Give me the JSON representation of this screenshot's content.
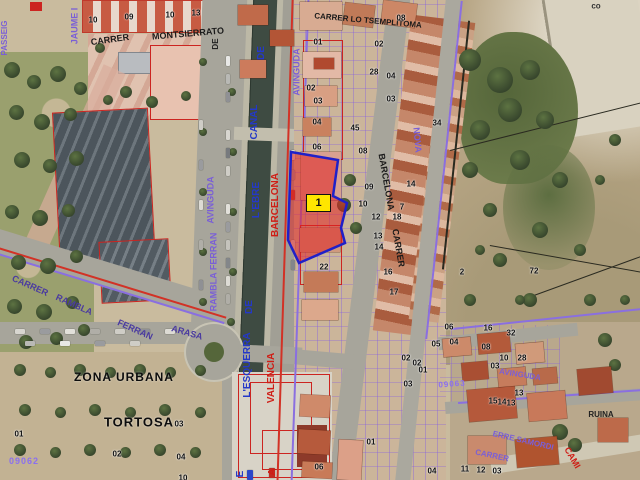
{
  "map": {
    "highlight_parcel": {
      "label": "1"
    },
    "zone_labels": {
      "zona_urbana": "ZONA URBANA",
      "municipality": "TORTOSA"
    },
    "zone_ids": {
      "left": "09062",
      "right": "09063"
    },
    "corner_label": "co",
    "street_labels": [
      {
        "id": "carrer-topleft",
        "text": "CARRER",
        "x": 110,
        "y": 40,
        "rot": -8,
        "color": "#1a1a1a",
        "size": 9
      },
      {
        "id": "montserrat",
        "text": "MONTSIERRATO",
        "x": 188,
        "y": 34,
        "rot": -5,
        "color": "#1a1a1a",
        "size": 9
      },
      {
        "id": "carrer-lo",
        "text": "CARRER LO TSEMPLITOMA",
        "x": 368,
        "y": 21,
        "rot": 5,
        "color": "#1a1a1a",
        "size": 8
      },
      {
        "id": "jaume-i",
        "text": "JAUME I",
        "x": 75,
        "y": 26,
        "rot": -90,
        "color": "#7a5fd6",
        "size": 9
      },
      {
        "id": "passeig",
        "text": "PASSEIG",
        "x": 5,
        "y": 38,
        "rot": -90,
        "color": "#7a5fd6",
        "size": 8
      },
      {
        "id": "de-black",
        "text": "DE",
        "x": 216,
        "y": 44,
        "rot": -90,
        "color": "#222222",
        "size": 8
      },
      {
        "id": "canal-de-1",
        "text": "DE",
        "x": 262,
        "y": 53,
        "rot": -90,
        "color": "#2438c8",
        "size": 10
      },
      {
        "id": "canal",
        "text": "CANAL",
        "x": 255,
        "y": 122,
        "rot": -90,
        "color": "#2438c8",
        "size": 10
      },
      {
        "id": "canal-lebre",
        "text": "L'EBRE",
        "x": 257,
        "y": 200,
        "rot": -90,
        "color": "#2438c8",
        "size": 10
      },
      {
        "id": "canal-de-2",
        "text": "DE",
        "x": 250,
        "y": 307,
        "rot": -90,
        "color": "#2438c8",
        "size": 10
      },
      {
        "id": "canal-lesquerra",
        "text": "L'ESQUERRA",
        "x": 248,
        "y": 365,
        "rot": -90,
        "color": "#2438c8",
        "size": 10
      },
      {
        "id": "canal-e-frag",
        "text": "E",
        "x": 241,
        "y": 474,
        "rot": -90,
        "color": "#2438c8",
        "size": 10
      },
      {
        "id": "barcelona-red",
        "text": "BARCELONA",
        "x": 276,
        "y": 205,
        "rot": -90,
        "color": "#cf1d15",
        "size": 10
      },
      {
        "id": "valencia-red",
        "text": "VALENCIA",
        "x": 272,
        "y": 378,
        "rot": -90,
        "color": "#cf1d15",
        "size": 10
      },
      {
        "id": "a-red-frag",
        "text": "A",
        "x": 273,
        "y": 472,
        "rot": -90,
        "color": "#cf1d15",
        "size": 10
      },
      {
        "id": "avinguda-east",
        "text": "AVINGUDA",
        "x": 297,
        "y": 72,
        "rot": -90,
        "color": "#7a5fd6",
        "size": 9
      },
      {
        "id": "avinguda-west",
        "text": "AVINGUDA",
        "x": 211,
        "y": 200,
        "rot": -90,
        "color": "#7a5fd6",
        "size": 9
      },
      {
        "id": "rambla-ferran-vert",
        "text": "RAMBLA FERRAN",
        "x": 214,
        "y": 272,
        "rot": -90,
        "color": "#7a5fd6",
        "size": 9
      },
      {
        "id": "barcelona-street",
        "text": "BARCELONA",
        "x": 386,
        "y": 182,
        "rot": 80,
        "color": "#1a1a1a",
        "size": 9
      },
      {
        "id": "carrer-street",
        "text": "CARRER",
        "x": 398,
        "y": 248,
        "rot": 80,
        "color": "#1a1a1a",
        "size": 9
      },
      {
        "id": "nova",
        "text": "NOVA",
        "x": 417,
        "y": 140,
        "rot": 85,
        "color": "#7a5fd6",
        "size": 9
      },
      {
        "id": "carrer-sw",
        "text": "CARRER",
        "x": 30,
        "y": 286,
        "rot": 24,
        "color": "#4a3aa0",
        "size": 9
      },
      {
        "id": "rambla-sw",
        "text": "RAMBLA",
        "x": 74,
        "y": 305,
        "rot": 24,
        "color": "#4a3aa0",
        "size": 9
      },
      {
        "id": "ferran-sw",
        "text": "FERRAN",
        "x": 135,
        "y": 330,
        "rot": 24,
        "color": "#4a3aa0",
        "size": 9
      },
      {
        "id": "arasa-sw",
        "text": "ARASA",
        "x": 187,
        "y": 333,
        "rot": 16,
        "color": "#4a3aa0",
        "size": 9
      },
      {
        "id": "cami",
        "text": "CAMI",
        "x": 572,
        "y": 458,
        "rot": 60,
        "color": "#cf1d15",
        "size": 9
      },
      {
        "id": "ruina",
        "text": "RUINA",
        "x": 601,
        "y": 415,
        "rot": 0,
        "color": "#222222",
        "size": 8
      },
      {
        "id": "erre-samordi",
        "text": "ERRE SAMORDI",
        "x": 523,
        "y": 441,
        "rot": 13,
        "color": "#7a5fd6",
        "size": 8
      },
      {
        "id": "carrer-se",
        "text": "CARRER",
        "x": 492,
        "y": 456,
        "rot": 12,
        "color": "#7a5fd6",
        "size": 8
      },
      {
        "id": "avinguda-se",
        "text": "AVINGUDA",
        "x": 520,
        "y": 375,
        "rot": 9,
        "color": "#7a5fd6",
        "size": 8
      }
    ],
    "parcel_numbers": [
      {
        "t": "10",
        "x": 93,
        "y": 20
      },
      {
        "t": "09",
        "x": 129,
        "y": 17
      },
      {
        "t": "10",
        "x": 170,
        "y": 15
      },
      {
        "t": "13",
        "x": 196,
        "y": 13
      },
      {
        "t": "01",
        "x": 318,
        "y": 42
      },
      {
        "t": "02",
        "x": 311,
        "y": 88
      },
      {
        "t": "03",
        "x": 318,
        "y": 101
      },
      {
        "t": "04",
        "x": 317,
        "y": 122
      },
      {
        "t": "45",
        "x": 355,
        "y": 128
      },
      {
        "t": "06",
        "x": 317,
        "y": 147
      },
      {
        "t": "02",
        "x": 379,
        "y": 44
      },
      {
        "t": "08",
        "x": 401,
        "y": 18
      },
      {
        "t": "28",
        "x": 374,
        "y": 72
      },
      {
        "t": "04",
        "x": 391,
        "y": 76
      },
      {
        "t": "03",
        "x": 391,
        "y": 99
      },
      {
        "t": "34",
        "x": 437,
        "y": 123
      },
      {
        "t": "08",
        "x": 363,
        "y": 151
      },
      {
        "t": "09",
        "x": 369,
        "y": 187
      },
      {
        "t": "10",
        "x": 363,
        "y": 204
      },
      {
        "t": "12",
        "x": 376,
        "y": 217
      },
      {
        "t": "13",
        "x": 378,
        "y": 236
      },
      {
        "t": "14",
        "x": 379,
        "y": 247
      },
      {
        "t": "16",
        "x": 388,
        "y": 272
      },
      {
        "t": "17",
        "x": 394,
        "y": 292
      },
      {
        "t": "14",
        "x": 411,
        "y": 184
      },
      {
        "t": "7",
        "x": 402,
        "y": 207
      },
      {
        "t": "18",
        "x": 397,
        "y": 217
      },
      {
        "t": "22",
        "x": 324,
        "y": 267
      },
      {
        "t": "2",
        "x": 462,
        "y": 272
      },
      {
        "t": "72",
        "x": 534,
        "y": 271
      },
      {
        "t": "06",
        "x": 449,
        "y": 327
      },
      {
        "t": "16",
        "x": 488,
        "y": 328
      },
      {
        "t": "32",
        "x": 511,
        "y": 333
      },
      {
        "t": "05",
        "x": 436,
        "y": 344
      },
      {
        "t": "04",
        "x": 454,
        "y": 342
      },
      {
        "t": "08",
        "x": 486,
        "y": 347
      },
      {
        "t": "28",
        "x": 522,
        "y": 358
      },
      {
        "t": "02",
        "x": 406,
        "y": 358
      },
      {
        "t": "02",
        "x": 417,
        "y": 363
      },
      {
        "t": "10",
        "x": 504,
        "y": 358
      },
      {
        "t": "03",
        "x": 408,
        "y": 384
      },
      {
        "t": "03",
        "x": 495,
        "y": 366
      },
      {
        "t": "01",
        "x": 423,
        "y": 370
      },
      {
        "t": "13",
        "x": 519,
        "y": 393
      },
      {
        "t": "15",
        "x": 493,
        "y": 401
      },
      {
        "t": "14",
        "x": 502,
        "y": 402
      },
      {
        "t": "13",
        "x": 511,
        "y": 403
      },
      {
        "t": "03",
        "x": 179,
        "y": 424
      },
      {
        "t": "04",
        "x": 181,
        "y": 457
      },
      {
        "t": "10",
        "x": 183,
        "y": 478
      },
      {
        "t": "06",
        "x": 319,
        "y": 467
      },
      {
        "t": "01",
        "x": 371,
        "y": 442
      },
      {
        "t": "01",
        "x": 19,
        "y": 434
      },
      {
        "t": "02",
        "x": 117,
        "y": 454
      },
      {
        "t": "04",
        "x": 432,
        "y": 471
      },
      {
        "t": "11",
        "x": 465,
        "y": 469
      },
      {
        "t": "12",
        "x": 481,
        "y": 470
      },
      {
        "t": "03",
        "x": 497,
        "y": 471
      }
    ]
  }
}
